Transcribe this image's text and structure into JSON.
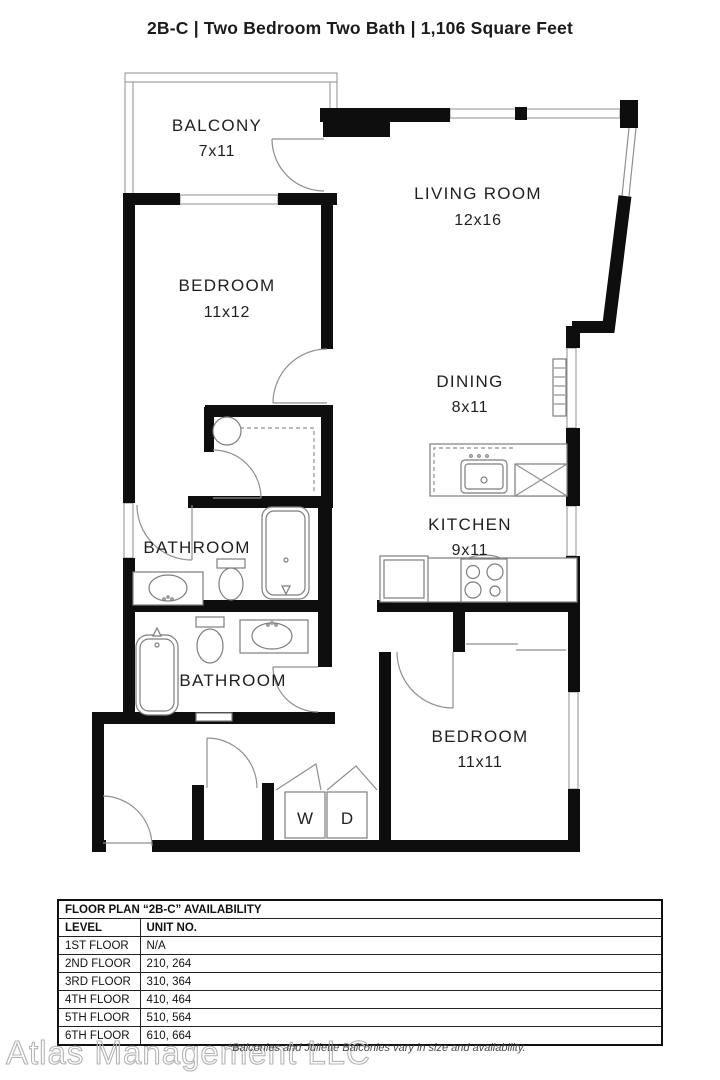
{
  "title": "2B-C | Two Bedroom Two Bath | 1,106 Square Feet",
  "floorplan": {
    "rooms": {
      "balcony": {
        "name": "BALCONY",
        "dims": "7x11"
      },
      "living": {
        "name": "LIVING ROOM",
        "dims": "12x16"
      },
      "bedroom1": {
        "name": "BEDROOM",
        "dims": "11x12"
      },
      "dining": {
        "name": "DINING",
        "dims": "8x11"
      },
      "kitchen": {
        "name": "KITCHEN",
        "dims": "9x11"
      },
      "bathroom1": {
        "name": "BATHROOM"
      },
      "bathroom2": {
        "name": "BATHROOM"
      },
      "bedroom2": {
        "name": "BEDROOM",
        "dims": "11x11"
      }
    },
    "laundry": {
      "washer": "W",
      "dryer": "D"
    }
  },
  "availability_table": {
    "title": "FLOOR PLAN “2B-C” AVAILABILITY",
    "columns": [
      "LEVEL",
      "UNIT NO."
    ],
    "rows": [
      {
        "level": "1ST FLOOR",
        "units": "N/A"
      },
      {
        "level": "2ND FLOOR",
        "units": "210, 264"
      },
      {
        "level": "3RD FLOOR",
        "units": "310, 364"
      },
      {
        "level": "4TH FLOOR",
        "units": "410, 464"
      },
      {
        "level": "5TH FLOOR",
        "units": "510, 564"
      },
      {
        "level": "6TH FLOOR",
        "units": "610, 664"
      }
    ]
  },
  "footer": {
    "watermark": "Atlas Management LLC",
    "note": "*Balconies and Juliette Balconies vary in size and availability."
  },
  "colors": {
    "wall": "#0e0e0e",
    "thin_line": "#8f8f8f",
    "text": "#1f1f1f"
  }
}
